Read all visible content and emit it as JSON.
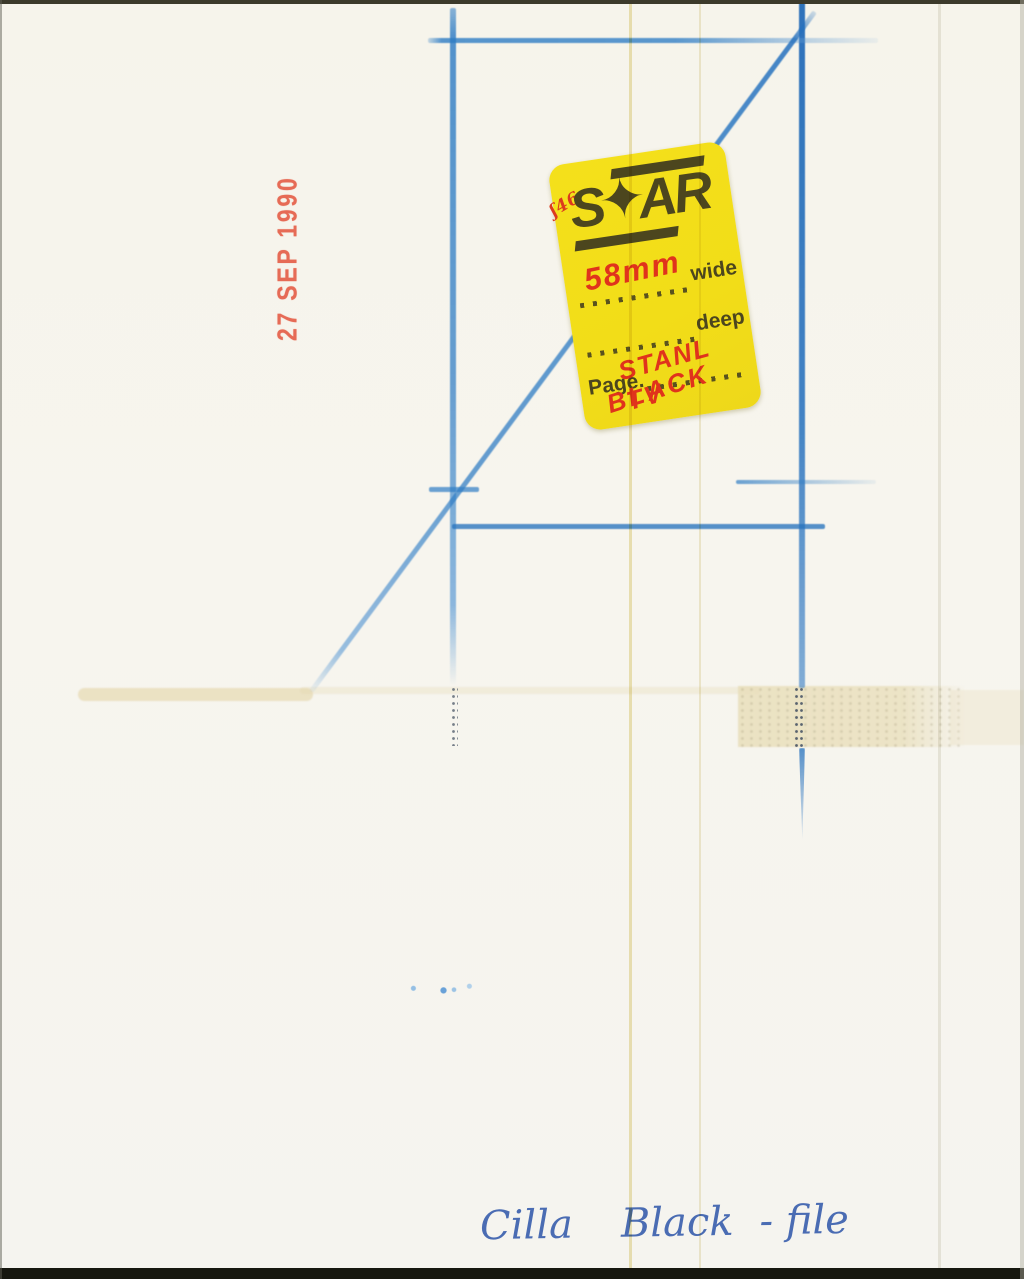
{
  "stamp": {
    "text": "27 SEP 1990"
  },
  "sticker": {
    "scribble": "ʃ46",
    "logo": {
      "left": "S",
      "star": "✦",
      "right": "AR"
    },
    "width_value": "58mm",
    "width_label": "wide",
    "deep_label": "deep",
    "page_label": "Page.",
    "page_value_line1": "STANL TV",
    "page_value_line2": "BLACK"
  },
  "annotation": {
    "parts": [
      "Cilla",
      "Black",
      "- file"
    ]
  },
  "colors": {
    "paper": "#f6f4ec",
    "crayon_blue": "#2e7cc4",
    "stamp_red": "#e5604a",
    "sticker_yellow": "#f3df1a",
    "sticker_ink_olive": "#4c461e",
    "marker_red": "#e0331c",
    "pen_blue": "#4a6cb3",
    "stain_tan": "#e8dec0"
  }
}
